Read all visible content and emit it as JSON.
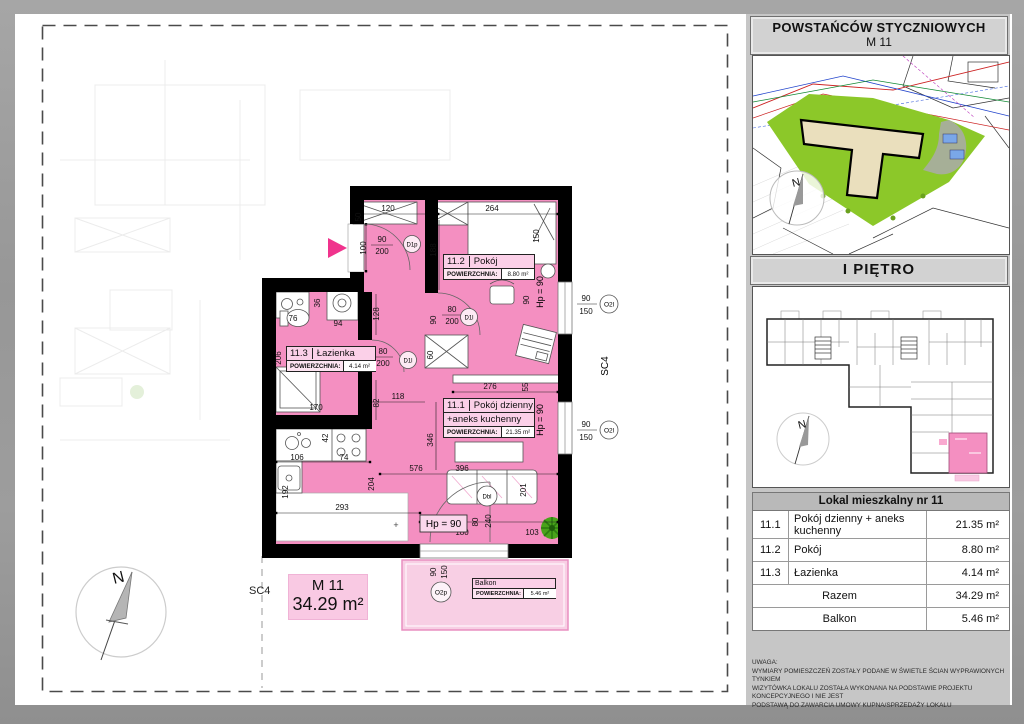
{
  "page": {
    "sc4_left": "SC4",
    "sc4_right": "SC4",
    "plus_mark": "+"
  },
  "compass": {
    "north": "N"
  },
  "plan": {
    "unit_label": {
      "name": "M 11",
      "area": "34.29 m²"
    },
    "rooms": [
      {
        "no": "11.2",
        "name": "Pokój",
        "area_label": "POWIERZCHNIA:",
        "area": "8.80 m²"
      },
      {
        "no": "11.3",
        "name": "Łazienka",
        "area_label": "POWIERZCHNIA:",
        "area": "4.14 m²"
      },
      {
        "no": "11.1",
        "name": "Pokój dzienny",
        "name2": "+aneks kuchenny",
        "area_label": "POWIERZCHNIA:",
        "area": "21.35 m²"
      }
    ],
    "balcony": {
      "name": "Balkon",
      "area_label": "POWIERZCHNIA:",
      "area": "5.46 m²"
    },
    "sill": {
      "v1": "Hp = 90",
      "v2": "Hp = 90",
      "box": "Hp = 90"
    },
    "windows": [
      "O2l",
      "O2l",
      "O2p"
    ],
    "doors": [
      "D1p",
      "D1l",
      "D1l",
      "Dbl"
    ],
    "dims": [
      "50",
      "120",
      "264",
      "90",
      "200",
      "100",
      "188",
      "150",
      "90",
      "80",
      "200",
      "36",
      "76",
      "94",
      "128",
      "206",
      "80",
      "200",
      "90",
      "170",
      "118",
      "82",
      "42",
      "106",
      "74",
      "192",
      "204",
      "293",
      "576",
      "346",
      "396",
      "276",
      "55",
      "60",
      "90",
      "180",
      "103",
      "201",
      "80",
      "240",
      "90",
      "150",
      "90",
      "150",
      "90",
      "150",
      "90"
    ]
  },
  "sidebar": {
    "header": {
      "line1": "POWSTAŃCÓW STYCZNIOWYCH",
      "line2": "M 11"
    },
    "floor_header": "I PIĘTRO",
    "table": {
      "title": "Lokal mieszkalny nr 11",
      "rows": [
        {
          "no": "11.1",
          "name": "Pokój dzienny + aneks kuchenny",
          "area": "21.35 m²"
        },
        {
          "no": "11.2",
          "name": "Pokój",
          "area": "8.80 m²"
        },
        {
          "no": "11.3",
          "name": "Łazienka",
          "area": "4.14 m²"
        }
      ],
      "total_label": "Razem",
      "total_area": "34.29 m²",
      "balcony_label": "Balkon",
      "balcony_area": "5.46 m²"
    },
    "disclaimer": [
      "UWAGA:",
      "WYMIARY POMIESZCZEŃ ZOSTAŁY PODANE W ŚWIETLE ŚCIAN WYPRAWIONYCH TYNKIEM",
      "WIZYTÓWKA LOKALU ZOSTAŁA WYKONANA NA PODSTAWIE PROJEKTU KONCEPCYJNEGO I NIE JEST",
      "PODSTAWĄ DO ZAWARCIA UMOWY KUPNA/SPRZEDAŻY LOKALU"
    ]
  }
}
